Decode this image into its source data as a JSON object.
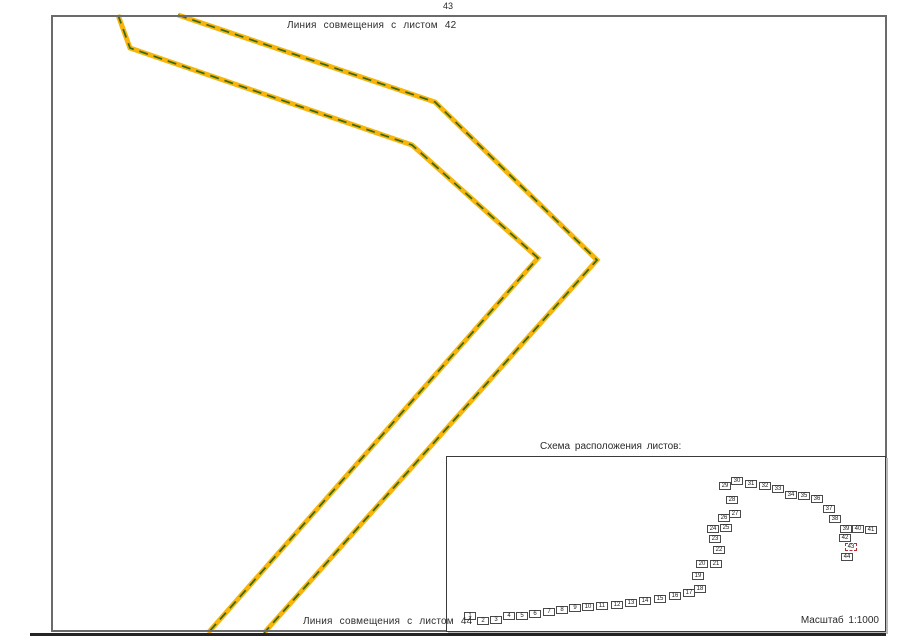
{
  "page": {
    "sheet_number_top": "43",
    "caption_top": "Линия совмещения с листом 42",
    "caption_bottom": "Линия совмещения с листом 44"
  },
  "inset": {
    "title": "Схема расположения листов:",
    "scale_label": "Масштаб 1:1000",
    "current_sheet": 43,
    "sheets": [
      {
        "n": 1,
        "x": 469,
        "y": 615
      },
      {
        "n": 2,
        "x": 482,
        "y": 620
      },
      {
        "n": 3,
        "x": 495,
        "y": 619
      },
      {
        "n": 4,
        "x": 508,
        "y": 615
      },
      {
        "n": 5,
        "x": 521,
        "y": 615
      },
      {
        "n": 6,
        "x": 534,
        "y": 613
      },
      {
        "n": 7,
        "x": 548,
        "y": 611
      },
      {
        "n": 8,
        "x": 561,
        "y": 609
      },
      {
        "n": 9,
        "x": 574,
        "y": 607
      },
      {
        "n": 10,
        "x": 587,
        "y": 606
      },
      {
        "n": 11,
        "x": 601,
        "y": 605
      },
      {
        "n": 12,
        "x": 616,
        "y": 604
      },
      {
        "n": 13,
        "x": 630,
        "y": 602
      },
      {
        "n": 14,
        "x": 644,
        "y": 600
      },
      {
        "n": 15,
        "x": 659,
        "y": 598
      },
      {
        "n": 16,
        "x": 674,
        "y": 595
      },
      {
        "n": 17,
        "x": 688,
        "y": 592
      },
      {
        "n": 18,
        "x": 699,
        "y": 588
      },
      {
        "n": 19,
        "x": 697,
        "y": 575
      },
      {
        "n": 20,
        "x": 701,
        "y": 563
      },
      {
        "n": 21,
        "x": 715,
        "y": 563
      },
      {
        "n": 22,
        "x": 718,
        "y": 549
      },
      {
        "n": 23,
        "x": 714,
        "y": 538
      },
      {
        "n": 24,
        "x": 712,
        "y": 528
      },
      {
        "n": 25,
        "x": 725,
        "y": 527
      },
      {
        "n": 26,
        "x": 723,
        "y": 517
      },
      {
        "n": 27,
        "x": 734,
        "y": 513
      },
      {
        "n": 28,
        "x": 731,
        "y": 499
      },
      {
        "n": 29,
        "x": 724,
        "y": 485
      },
      {
        "n": 30,
        "x": 736,
        "y": 480
      },
      {
        "n": 31,
        "x": 750,
        "y": 483
      },
      {
        "n": 32,
        "x": 764,
        "y": 485
      },
      {
        "n": 33,
        "x": 777,
        "y": 488
      },
      {
        "n": 34,
        "x": 790,
        "y": 494
      },
      {
        "n": 35,
        "x": 803,
        "y": 495
      },
      {
        "n": 36,
        "x": 816,
        "y": 498
      },
      {
        "n": 37,
        "x": 828,
        "y": 508
      },
      {
        "n": 38,
        "x": 834,
        "y": 518
      },
      {
        "n": 39,
        "x": 845,
        "y": 528
      },
      {
        "n": 40,
        "x": 857,
        "y": 528
      },
      {
        "n": 41,
        "x": 870,
        "y": 529
      },
      {
        "n": 42,
        "x": 844,
        "y": 537
      },
      {
        "n": 43,
        "x": 850,
        "y": 546
      },
      {
        "n": 44,
        "x": 846,
        "y": 556
      }
    ]
  },
  "route_lines": {
    "color_fill": "#F7B50C",
    "color_dash": "#336914",
    "line_a_points": "118,15 130,48 412,145 538,258 208,633",
    "line_b_points": "178,15 435,102 597,260 264,633"
  },
  "colors": {
    "highlight_red": "#B03030",
    "frame_gray": "#6B6B6B"
  }
}
